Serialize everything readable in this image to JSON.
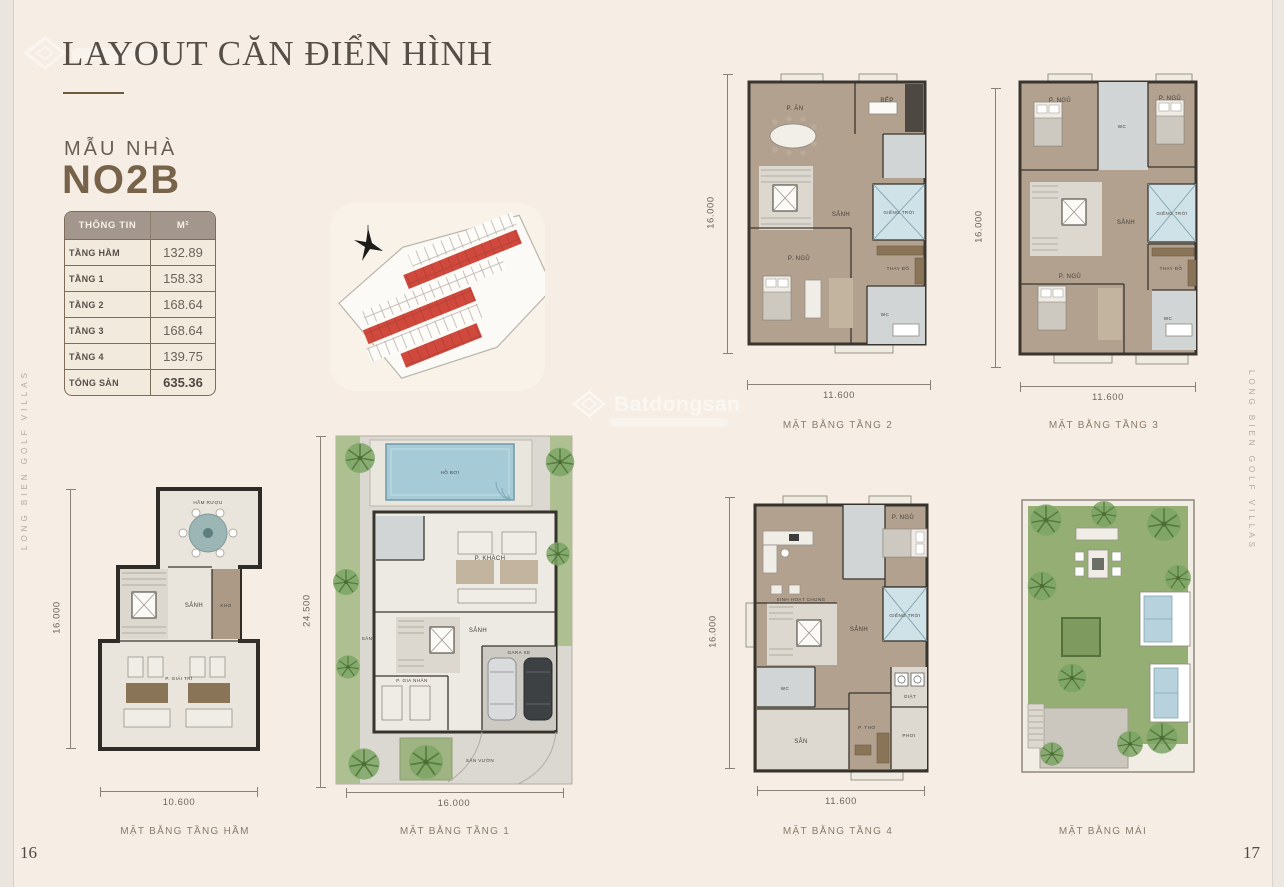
{
  "page": {
    "title": "LAYOUT CĂN ĐIỂN HÌNH",
    "page_number_left": "16",
    "page_number_right": "17",
    "side_text": "LONG BIEN GOLF VILLAS",
    "watermark_text": "Batdongsan",
    "bg_color": "#f6eee5"
  },
  "model": {
    "label": "MẪU NHÀ",
    "name": "NO2B"
  },
  "info_table": {
    "header": {
      "col1": "THÔNG TIN",
      "col2": "M²"
    },
    "rows": [
      {
        "label": "TẦNG HẦM",
        "value": "132.89"
      },
      {
        "label": "TẦNG 1",
        "value": "158.33"
      },
      {
        "label": "TẦNG 2",
        "value": "168.64"
      },
      {
        "label": "TẦNG 3",
        "value": "168.64"
      },
      {
        "label": "TẦNG 4",
        "value": "139.75"
      },
      {
        "label": "TỔNG SÀN",
        "value": "635.36"
      }
    ]
  },
  "colors": {
    "highlight_red": "#d0493c",
    "skylight_blue": "#cfe2e8",
    "table_header_bg": "#a3968c"
  },
  "plans": {
    "basement": {
      "caption": "MẶT BẰNG TẦNG HẦM",
      "dim_width": "10.600",
      "dim_height": "16.000",
      "rooms": {
        "wine_cellar": "HẦM RƯỢU",
        "hall": "SẢNH",
        "storage": "KHO",
        "entertainment": "P. GIẢI TRÍ"
      }
    },
    "floor1": {
      "caption": "MẶT BẰNG TẦNG 1",
      "dim_width": "16.000",
      "dim_height": "24.500",
      "rooms": {
        "pool": "HỒ BƠI",
        "living": "P. KHÁCH",
        "hall": "SẢNH",
        "garage": "GARA XE",
        "maid": "P. GIA NHÂN",
        "yard": "SÂN",
        "garden": "SÂN VƯỜN"
      }
    },
    "floor2": {
      "caption": "MẶT BẰNG TẦNG 2",
      "dim_width": "11.600",
      "dim_height": "16.000",
      "rooms": {
        "dining": "P. ĂN",
        "kitchen": "BẾP",
        "hall": "SẢNH",
        "skylight": "GIẾNG TRỜI",
        "bedroom": "P. NGỦ",
        "dressing": "THAY ĐỒ",
        "wc": "WC"
      }
    },
    "floor3": {
      "caption": "MẶT BẰNG TẦNG 3",
      "dim_width": "11.600",
      "dim_height": "16.000",
      "rooms": {
        "bedroom1": "P. NGỦ",
        "wc1": "WC",
        "bedroom2": "P. NGỦ",
        "hall": "SẢNH",
        "skylight": "GIẾNG TRỜI",
        "bedroom3": "P. NGỦ",
        "dressing": "THAY ĐỒ",
        "wc2": "WC"
      }
    },
    "floor4": {
      "caption": "MẶT BẰNG TẦNG 4",
      "dim_width": "11.600",
      "dim_height": "16.000",
      "rooms": {
        "common": "SINH HOẠT CHUNG",
        "wc1": "WC",
        "bedroom": "P. NGỦ",
        "hall": "SẢNH",
        "skylight": "GIẾNG TRỜI",
        "laundry": "GIẶT",
        "drying": "PHƠI",
        "yard": "SÂN",
        "worship": "P. THỜ"
      }
    },
    "roof": {
      "caption": "MẶT BẰNG MÁI"
    }
  }
}
